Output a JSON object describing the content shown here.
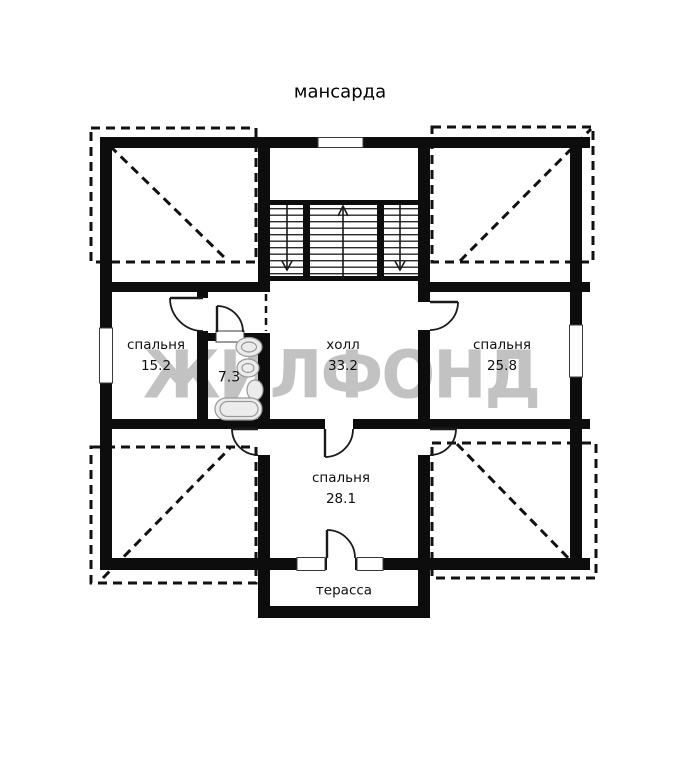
{
  "title": "мансарда",
  "watermark": "ЖИЛФОНД",
  "rooms": [
    {
      "id": "bedroom-15",
      "name": "спальня",
      "area": "15.2"
    },
    {
      "id": "bathroom",
      "name": "",
      "area": "7.3"
    },
    {
      "id": "hall",
      "name": "холл",
      "area": "33.2"
    },
    {
      "id": "bedroom-25",
      "name": "спальня",
      "area": "25.8"
    },
    {
      "id": "bedroom-28",
      "name": "спальня",
      "area": "28.1"
    },
    {
      "id": "terrace",
      "name": "терасса",
      "area": ""
    }
  ],
  "colors": {
    "wall": "#0d0d0d",
    "thin_line": "#1a1a1a",
    "watermark": "#c2c2c2",
    "fixture_fill": "#ececec",
    "fixture_stroke": "#999999"
  }
}
